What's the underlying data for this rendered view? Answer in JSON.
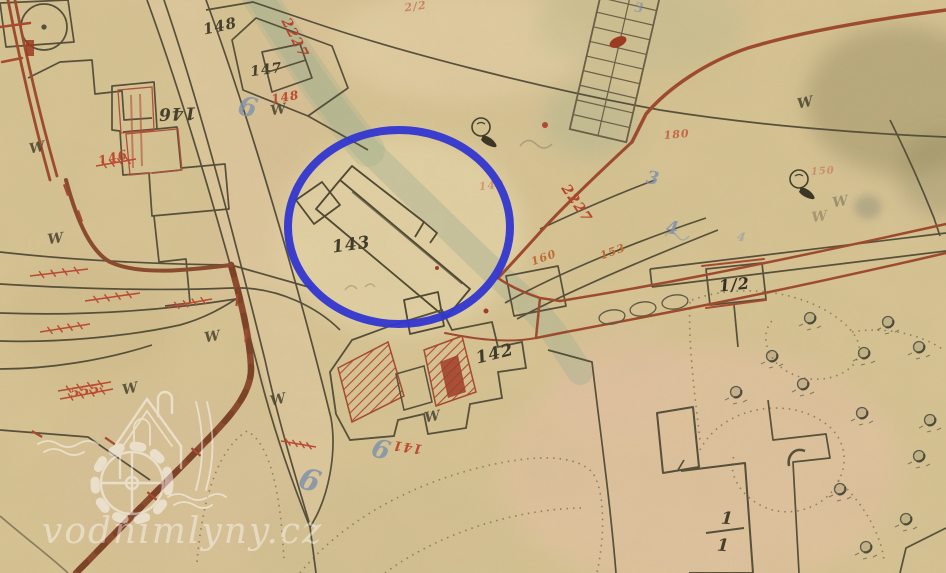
{
  "map": {
    "watermark": {
      "text": "vodnimlyny.cz"
    },
    "highlight": {
      "cx": 399,
      "cy": 227,
      "rx": 111,
      "ry": 97,
      "color": "#3136d0",
      "stroke_width": 8
    },
    "palette": {
      "paper": "#d8c596",
      "ink": "#564f3a",
      "road_red": "#9e4a2e",
      "note_red": "#c0452e",
      "pencil_blue": "#7e93ac",
      "stream_green": "#a9b394",
      "watermark_white": "#ffffff"
    },
    "labels": [
      {
        "id": "parcel-148-top",
        "text": "148",
        "x": 221,
        "y": 31,
        "rot": -12,
        "size": 15,
        "color": "#453e2c"
      },
      {
        "id": "parcel-147",
        "text": "147",
        "x": 267,
        "y": 74,
        "rot": -8,
        "size": 14,
        "color": "#453e2c"
      },
      {
        "id": "parcel-146",
        "text": "146",
        "x": 177,
        "y": 108,
        "rot": 178,
        "size": 17,
        "color": "#453e2c"
      },
      {
        "id": "parcel-143",
        "text": "143",
        "x": 352,
        "y": 250,
        "rot": -8,
        "size": 17,
        "color": "#3f3a2a"
      },
      {
        "id": "parcel-142",
        "text": "142",
        "x": 496,
        "y": 359,
        "rot": -14,
        "size": 17,
        "color": "#3f3a2a"
      },
      {
        "id": "parcel-1-2",
        "text": "1/2",
        "x": 735,
        "y": 290,
        "rot": -6,
        "size": 16,
        "color": "#352f22"
      },
      {
        "id": "house-1-1-numerator",
        "text": "1",
        "x": 727,
        "y": 524,
        "rot": 4,
        "size": 17,
        "color": "#453e2c"
      },
      {
        "id": "house-1-1-denominator",
        "text": "1",
        "x": 723,
        "y": 551,
        "rot": 4,
        "size": 17,
        "color": "#453e2c"
      },
      {
        "id": "red-2227-upper",
        "text": "2227",
        "x": 291,
        "y": 40,
        "rot": 63,
        "size": 14,
        "color": "#b8432c"
      },
      {
        "id": "red-2227-lower",
        "text": "2227",
        "x": 573,
        "y": 206,
        "rot": 56,
        "size": 14,
        "color": "#b8432c"
      },
      {
        "id": "red-148",
        "text": "148",
        "x": 286,
        "y": 101,
        "rot": -10,
        "size": 12,
        "color": "#c04a30"
      },
      {
        "id": "red-146",
        "text": "146",
        "x": 114,
        "y": 162,
        "rot": -14,
        "size": 13,
        "color": "#c04a30"
      },
      {
        "id": "red-555",
        "text": "555",
        "x": 86,
        "y": 395,
        "rot": -9,
        "size": 13,
        "color": "#c04a30"
      },
      {
        "id": "red-141",
        "text": "141",
        "x": 408,
        "y": 443,
        "rot": 188,
        "size": 13,
        "color": "#c04a30"
      },
      {
        "id": "red-180",
        "text": "180",
        "x": 677,
        "y": 138,
        "rot": -5,
        "size": 11,
        "color": "#c04a30",
        "opacity": 0.75
      },
      {
        "id": "red-150",
        "text": "150",
        "x": 823,
        "y": 174,
        "rot": -4,
        "size": 10,
        "color": "#c05a40",
        "opacity": 0.5
      },
      {
        "id": "red-149",
        "text": "149",
        "x": 492,
        "y": 189,
        "rot": -6,
        "size": 11,
        "color": "#c05a40",
        "opacity": 0.45
      },
      {
        "id": "red-2-2",
        "text": "2/2",
        "x": 416,
        "y": 10,
        "rot": -8,
        "size": 11,
        "color": "#c04a30",
        "opacity": 0.55
      },
      {
        "id": "orange-160",
        "text": "160",
        "x": 545,
        "y": 261,
        "rot": -20,
        "size": 11,
        "color": "#bf6a33"
      },
      {
        "id": "orange-153",
        "text": "153",
        "x": 614,
        "y": 255,
        "rot": -20,
        "size": 11,
        "color": "#bf6a33"
      },
      {
        "id": "blue-6-top",
        "text": "6",
        "x": 246,
        "y": 116,
        "rot": 14,
        "size": 27,
        "color": "#7e93ac",
        "opacity": 0.8
      },
      {
        "id": "blue-6-street",
        "text": "6",
        "x": 307,
        "y": 490,
        "rot": 18,
        "size": 30,
        "color": "#7e93ac",
        "opacity": 0.85
      },
      {
        "id": "blue-6-mid",
        "text": "6",
        "x": 379,
        "y": 458,
        "rot": 16,
        "size": 26,
        "color": "#7e93ac",
        "opacity": 0.85
      },
      {
        "id": "blue-3",
        "text": "3",
        "x": 652,
        "y": 184,
        "rot": 10,
        "size": 18,
        "color": "#7e93ac",
        "opacity": 0.85
      },
      {
        "id": "blue-4",
        "text": "4",
        "x": 672,
        "y": 234,
        "rot": 8,
        "size": 18,
        "color": "#7e93ac",
        "opacity": 0.85
      },
      {
        "id": "blue-3-top",
        "text": "3",
        "x": 639,
        "y": 12,
        "rot": 6,
        "size": 13,
        "color": "#7e93ac",
        "opacity": 0.7
      },
      {
        "id": "blue-4-small",
        "text": "4",
        "x": 741,
        "y": 241,
        "rot": 10,
        "size": 12,
        "color": "#7e93ac",
        "opacity": 0.5
      }
    ],
    "symbols": {
      "meadow_w": [
        {
          "x": 38,
          "y": 152,
          "rot": -12
        },
        {
          "x": 279,
          "y": 114,
          "rot": -10
        },
        {
          "x": 56,
          "y": 243,
          "rot": -8
        },
        {
          "x": 131,
          "y": 393,
          "rot": -12
        },
        {
          "x": 279,
          "y": 404,
          "rot": -14
        },
        {
          "x": 433,
          "y": 421,
          "rot": -10
        },
        {
          "x": 806,
          "y": 107,
          "rot": -12
        },
        {
          "x": 213,
          "y": 341,
          "rot": -10
        },
        {
          "x": 841,
          "y": 206,
          "rot": -10,
          "opacity": 0.4
        },
        {
          "x": 820,
          "y": 221,
          "rot": -8,
          "opacity": 0.35
        }
      ],
      "tree_rings": [
        {
          "x": 481,
          "y": 127
        },
        {
          "x": 799,
          "y": 179
        }
      ],
      "orchard_trees": [
        {
          "x": 772,
          "y": 356
        },
        {
          "x": 803,
          "y": 384
        },
        {
          "x": 810,
          "y": 318
        },
        {
          "x": 888,
          "y": 322
        },
        {
          "x": 919,
          "y": 347
        },
        {
          "x": 864,
          "y": 353
        },
        {
          "x": 862,
          "y": 413
        },
        {
          "x": 919,
          "y": 456
        },
        {
          "x": 840,
          "y": 489
        },
        {
          "x": 906,
          "y": 519
        },
        {
          "x": 866,
          "y": 547
        },
        {
          "x": 930,
          "y": 420
        },
        {
          "x": 736,
          "y": 392
        }
      ],
      "road_bushes": [
        {
          "x": 612,
          "y": 317
        },
        {
          "x": 643,
          "y": 309
        },
        {
          "x": 675,
          "y": 302
        }
      ],
      "red_ticks": [
        {
          "x": 66,
          "y": 190,
          "rot": 70
        },
        {
          "x": 80,
          "y": 216,
          "rot": 70
        },
        {
          "x": 237,
          "y": 300,
          "rot": 95
        },
        {
          "x": 246,
          "y": 336,
          "rot": 95
        },
        {
          "x": 196,
          "y": 452,
          "rot": 40
        },
        {
          "x": 152,
          "y": 496,
          "rot": 40
        },
        {
          "x": 110,
          "y": 441,
          "rot": 35
        },
        {
          "x": 37,
          "y": 434,
          "rot": 30
        }
      ],
      "red_rows": [
        {
          "x1": 30,
          "y1": 276,
          "x2": 88,
          "y2": 269
        },
        {
          "x1": 85,
          "y1": 301,
          "x2": 140,
          "y2": 293
        },
        {
          "x1": 168,
          "y1": 307,
          "x2": 212,
          "y2": 299
        },
        {
          "x1": 40,
          "y1": 332,
          "x2": 90,
          "y2": 324
        },
        {
          "x1": 281,
          "y1": 441,
          "x2": 316,
          "y2": 447
        },
        {
          "x1": 96,
          "y1": 166,
          "x2": 136,
          "y2": 159
        },
        {
          "x1": 60,
          "y1": 399,
          "x2": 113,
          "y2": 389
        },
        {
          "x1": 58,
          "y1": 391,
          "x2": 111,
          "y2": 382
        }
      ]
    }
  }
}
